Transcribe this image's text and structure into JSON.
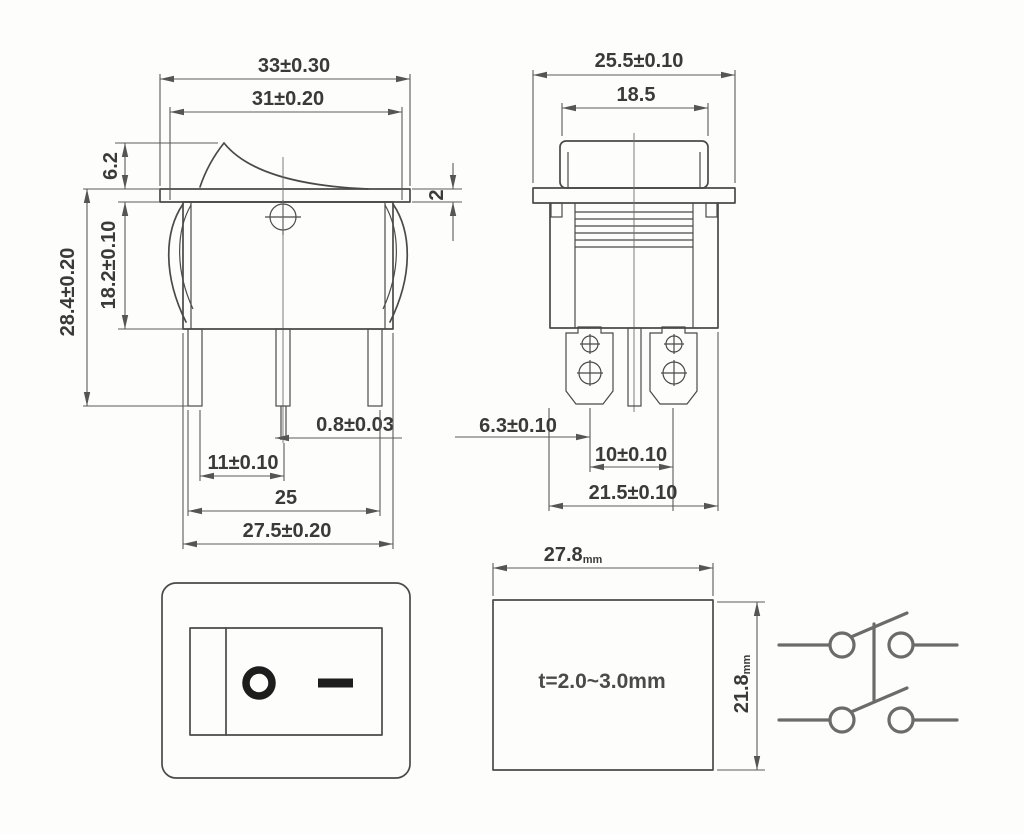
{
  "drawing_title": "rocker switch dimensional drawing",
  "side_view": {
    "dims": {
      "flange_width": "33±0.30",
      "upper_body_width": "31±0.20",
      "actuator_height": "6.2",
      "flange_thickness": "2",
      "body_depth": "18.2±0.10",
      "overall_height": "28.4±0.20",
      "terminal_thickness": "0.8±0.03",
      "terminal_gap": "11±0.10",
      "terminal_span": "25",
      "body_width": "27.5±0.20"
    }
  },
  "front_view": {
    "dims": {
      "flange_width": "25.5±0.10",
      "rocker_width": "18.5",
      "terminal_offset": "6.3±0.10",
      "terminal_pitch": "10±0.10",
      "body_width": "21.5±0.10"
    }
  },
  "panel_cutout": {
    "width_value": "27.8",
    "width_unit": "mm",
    "height_value": "21.8",
    "height_unit": "mm",
    "panel_thickness_note": "t=2.0~3.0mm"
  },
  "face_view": {
    "symbols": {
      "off": "O-ring",
      "on": "dash"
    }
  },
  "schematic": {
    "symbol": "dpst-4-terminal-switch"
  },
  "colors": {
    "line": "#4a4a4a",
    "dim_line": "#5a5a5a",
    "text": "#3a3a3a",
    "symbol": "#1d1d1d",
    "schematic_line": "#6b6b6b",
    "background": "#fdfdfc"
  }
}
